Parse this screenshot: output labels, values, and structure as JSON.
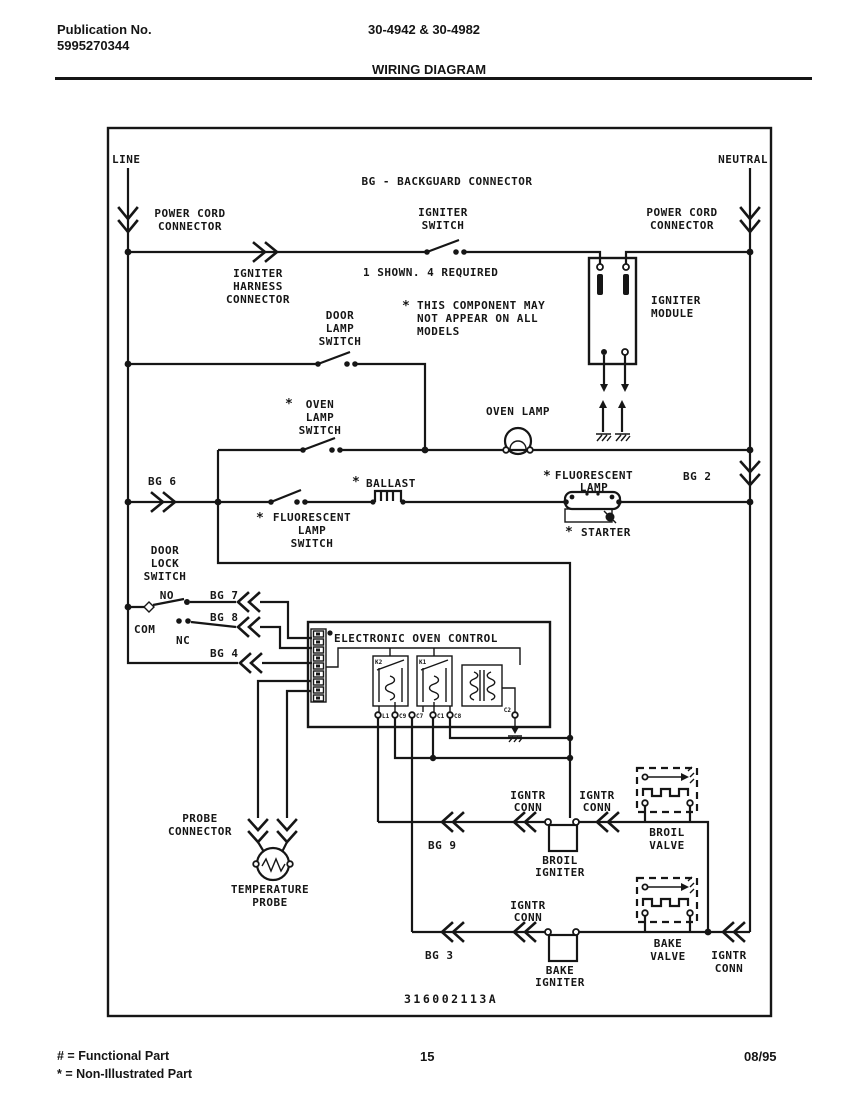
{
  "page": {
    "header": {
      "publication_label": "Publication No.",
      "publication_number": "5995270344",
      "model_numbers": "30-4942 & 30-4982",
      "title": "WIRING DIAGRAM"
    },
    "footer": {
      "functional_note": "# = Functional Part",
      "non_illustrated_note": "* = Non-Illustrated Part",
      "page_number": "15",
      "date": "08/95"
    }
  },
  "diagram": {
    "part_number": "316002113A",
    "labels": {
      "line": "LINE",
      "neutral": "NEUTRAL",
      "backguard": "BG - BACKGUARD CONNECTOR",
      "power_cord": [
        "POWER CORD",
        "CONNECTOR"
      ],
      "igniter_switch": [
        "IGNITER",
        "SWITCH"
      ],
      "igniter_harness": [
        "IGNITER",
        "HARNESS",
        "CONNECTOR"
      ],
      "shown_note": "1 SHOWN. 4 REQUIRED",
      "component_note": [
        "THIS COMPONENT MAY",
        "NOT APPEAR ON ALL",
        "MODELS"
      ],
      "door_lamp_switch": [
        "DOOR",
        "LAMP",
        "SWITCH"
      ],
      "igniter_module": [
        "IGNITER",
        "MODULE"
      ],
      "oven_lamp_switch": [
        "OVEN",
        "LAMP",
        "SWITCH"
      ],
      "oven_lamp": "OVEN LAMP",
      "ballast": "BALLAST",
      "fluorescent_lamp": [
        "FLUORESCENT",
        "LAMP"
      ],
      "fluorescent_lamp_switch": [
        "FLUORESCENT",
        "LAMP",
        "SWITCH"
      ],
      "starter": "STARTER",
      "door_lock_switch": [
        "DOOR",
        "LOCK",
        "SWITCH"
      ],
      "no": "NO",
      "com": "COM",
      "nc": "NC",
      "bg6": "BG 6",
      "bg2": "BG 2",
      "bg7": "BG 7",
      "bg8": "BG 8",
      "bg4": "BG 4",
      "bg9": "BG 9",
      "bg3": "BG 3",
      "eoc_title": "ELECTRONIC OVEN CONTROL",
      "relay1": "K2",
      "relay2": "K1",
      "eoc_pins": [
        "L1",
        "C9",
        "C7",
        "C1",
        "C8",
        "C2"
      ],
      "probe_connector": [
        "PROBE",
        "CONNECTOR"
      ],
      "temperature_probe": [
        "TEMPERATURE",
        "PROBE"
      ],
      "igntr_conn": [
        "IGNTR",
        "CONN"
      ],
      "broil_igniter": [
        "BROIL",
        "IGNITER"
      ],
      "broil_valve": [
        "BROIL",
        "VALVE"
      ],
      "bake_igniter": [
        "BAKE",
        "IGNITER"
      ],
      "bake_valve": [
        "BAKE",
        "VALVE"
      ],
      "asterisk": "*"
    }
  }
}
